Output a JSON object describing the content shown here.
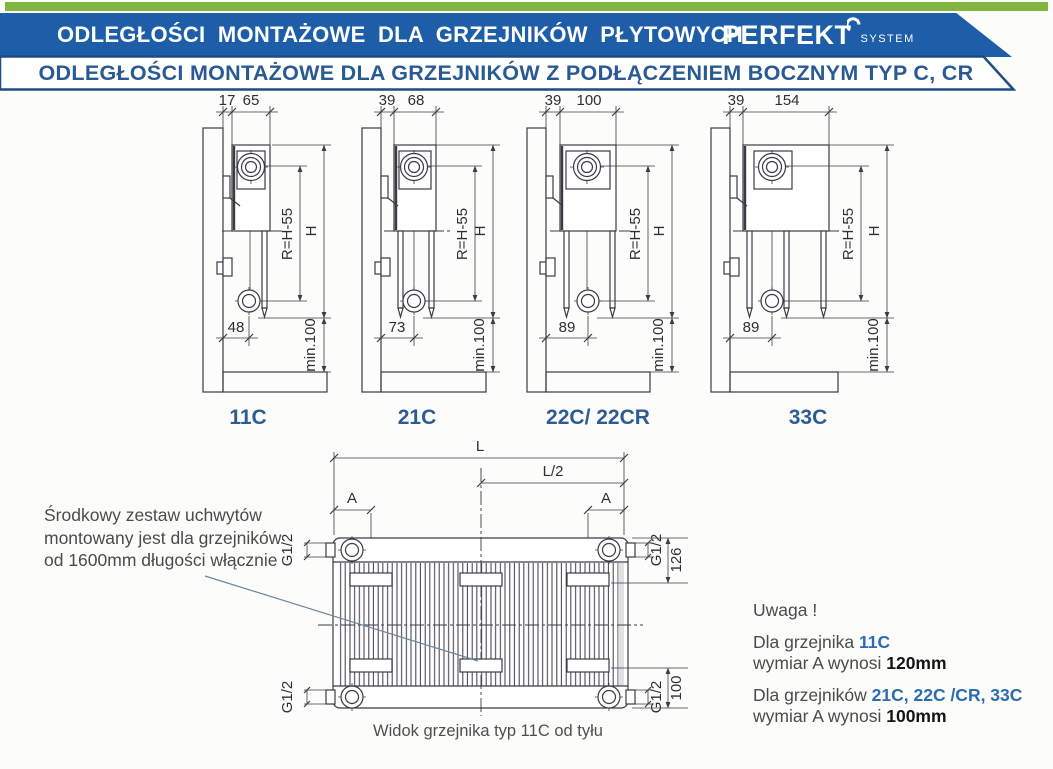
{
  "header": {
    "title": "ODLEGŁOŚCI MONTAŻOWE DLA GRZEJNIKÓW PŁYTOWYCH",
    "brand": "PERFEKT",
    "brand_sub": "SYSTEM",
    "subtitle": "ODLEGŁOŚCI MONTAŻOWE DLA GRZEJNIKÓW Z PODŁĄCZENIEM BOCZNYM TYP C, CR",
    "colors": {
      "green": "#82b440",
      "banner_blue": "#1e5ea8",
      "title_blue": "#2a5a93"
    }
  },
  "shared": {
    "r": "R=H-55",
    "h": "H",
    "min": "min.100"
  },
  "diagrams": [
    {
      "label": "11C",
      "gap": "17",
      "depth": "65",
      "bottom": "48"
    },
    {
      "label": "21C",
      "gap": "39",
      "depth": "68",
      "bottom": "73"
    },
    {
      "label": "22C/ 22CR",
      "gap": "39",
      "depth": "100",
      "bottom": "89"
    },
    {
      "label": "33C",
      "gap": "39",
      "depth": "154",
      "bottom": "89"
    }
  ],
  "bottom_view": {
    "l": "L",
    "l_half": "L/2",
    "a": "A",
    "thread": "G1/2",
    "depth_dim": "126",
    "height_dim": "100",
    "caption": "Widok grzejnika typ 11C od tyłu"
  },
  "notes": {
    "left_line1": "Środkowy zestaw uchwytów",
    "left_line2": "montowany jest dla grzejników",
    "left_line3": "od 1600mm długości włącznie",
    "warning": "Uwaga !",
    "n1_prefix": "Dla grzejnika ",
    "n1_models": "11C",
    "n1_dim_prefix": "wymiar A wynosi ",
    "n1_dim_value": "120mm",
    "n2_prefix": "Dla grzejników ",
    "n2_models": "21C, 22C /CR, 33C",
    "n2_dim_prefix": "wymiar A wynosi ",
    "n2_dim_value": "100mm"
  }
}
